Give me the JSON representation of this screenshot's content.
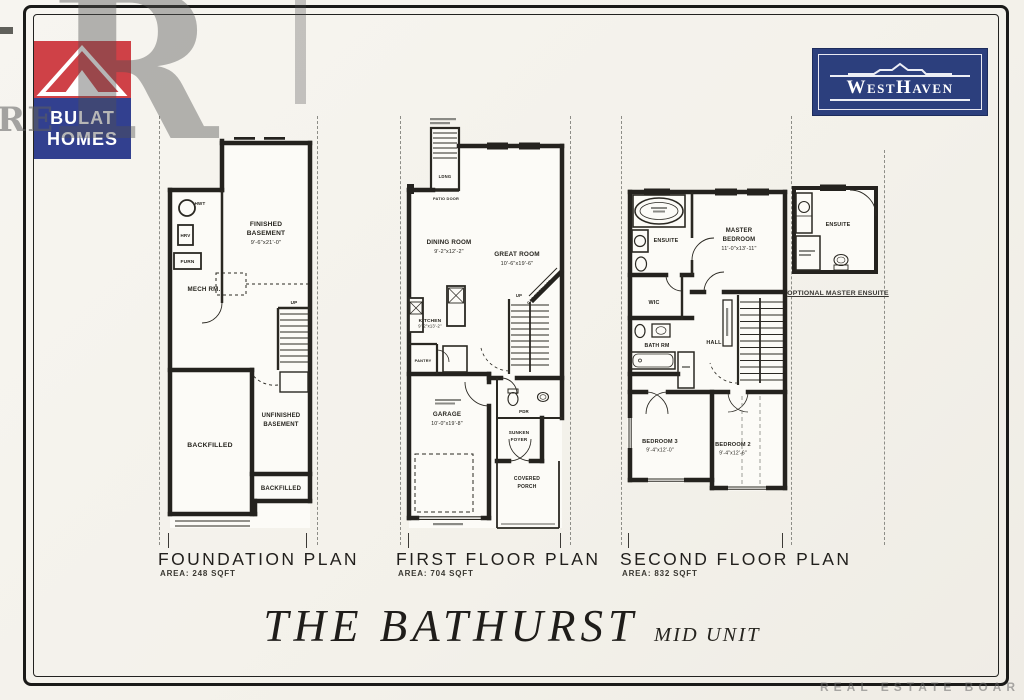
{
  "branding": {
    "bulat": {
      "line1": "BULAT",
      "line2": "HOMES"
    },
    "westhaven": {
      "name": "WestHaven"
    }
  },
  "watermarks": {
    "big_r": "R",
    "left_re": "RE",
    "bottom": "REAL ESTATE BOAR"
  },
  "colors": {
    "bulat_red": "#cf4147",
    "bulat_blue": "#32408f",
    "westhaven_navy": "#2c3f7d",
    "ink": "#211f1c"
  },
  "plans": {
    "foundation": {
      "title": "FOUNDATION PLAN",
      "area": "AREA: 248 SQFT",
      "labels": {
        "finished_l1": "FINISHED",
        "finished_l2": "BASEMENT",
        "finished_dim": "9'-6\"x21'-0\"",
        "mech": "MECH RM.",
        "hwt": "HWT",
        "hrv": "HRV",
        "furn": "FURN",
        "backfilled_main": "BACKFILLED",
        "unfinished_l1": "UNFINISHED",
        "unfinished_l2": "BASEMENT",
        "backfilled_lower": "BACKFILLED",
        "up": "UP"
      }
    },
    "first": {
      "title": "FIRST FLOOR PLAN",
      "area": "AREA: 704 SQFT",
      "labels": {
        "great_l1": "GREAT ROOM",
        "great_dim": "10'-6\"x19'-6\"",
        "dining_l1": "DINING ROOM",
        "dining_dim": "9'-2\"x12'-2\"",
        "kitchen_l1": "KITCHEN",
        "kitchen_dim": "9'-2\"x13'-2\"",
        "patio_door": "PATIO DOOR",
        "ldng": "LDNG",
        "pantry": "PANTRY",
        "pdr": "PDR",
        "garage_l1": "GARAGE",
        "garage_dim": "10'-0\"x19'-8\"",
        "sunken_l1": "SUNKEN",
        "sunken_l2": "FOYER",
        "porch_l1": "COVERED",
        "porch_l2": "PORCH",
        "fireplace": "GAS FIREPLACE",
        "up": "UP"
      }
    },
    "second": {
      "title": "SECOND FLOOR PLAN",
      "area": "AREA: 832 SQFT",
      "labels": {
        "ensuite": "ENSUITE",
        "master_l1": "MASTER",
        "master_l2": "BEDROOM",
        "master_dim": "11'-0\"x13'-11\"",
        "wic": "WIC",
        "bath": "BATH RM",
        "hall": "HALL",
        "bed3_l1": "BEDROOM 3",
        "bed3_dim": "9'-4\"x12'-0\"",
        "bed2_l1": "BEDROOM 2",
        "bed2_dim": "9'-4\"x12'-6\""
      }
    },
    "optional": {
      "ensuite": "ENSUITE",
      "caption": "OPTIONAL MASTER ENSUITE"
    }
  },
  "footer": {
    "title": "THE BATHURST",
    "subtitle": "MID UNIT"
  }
}
